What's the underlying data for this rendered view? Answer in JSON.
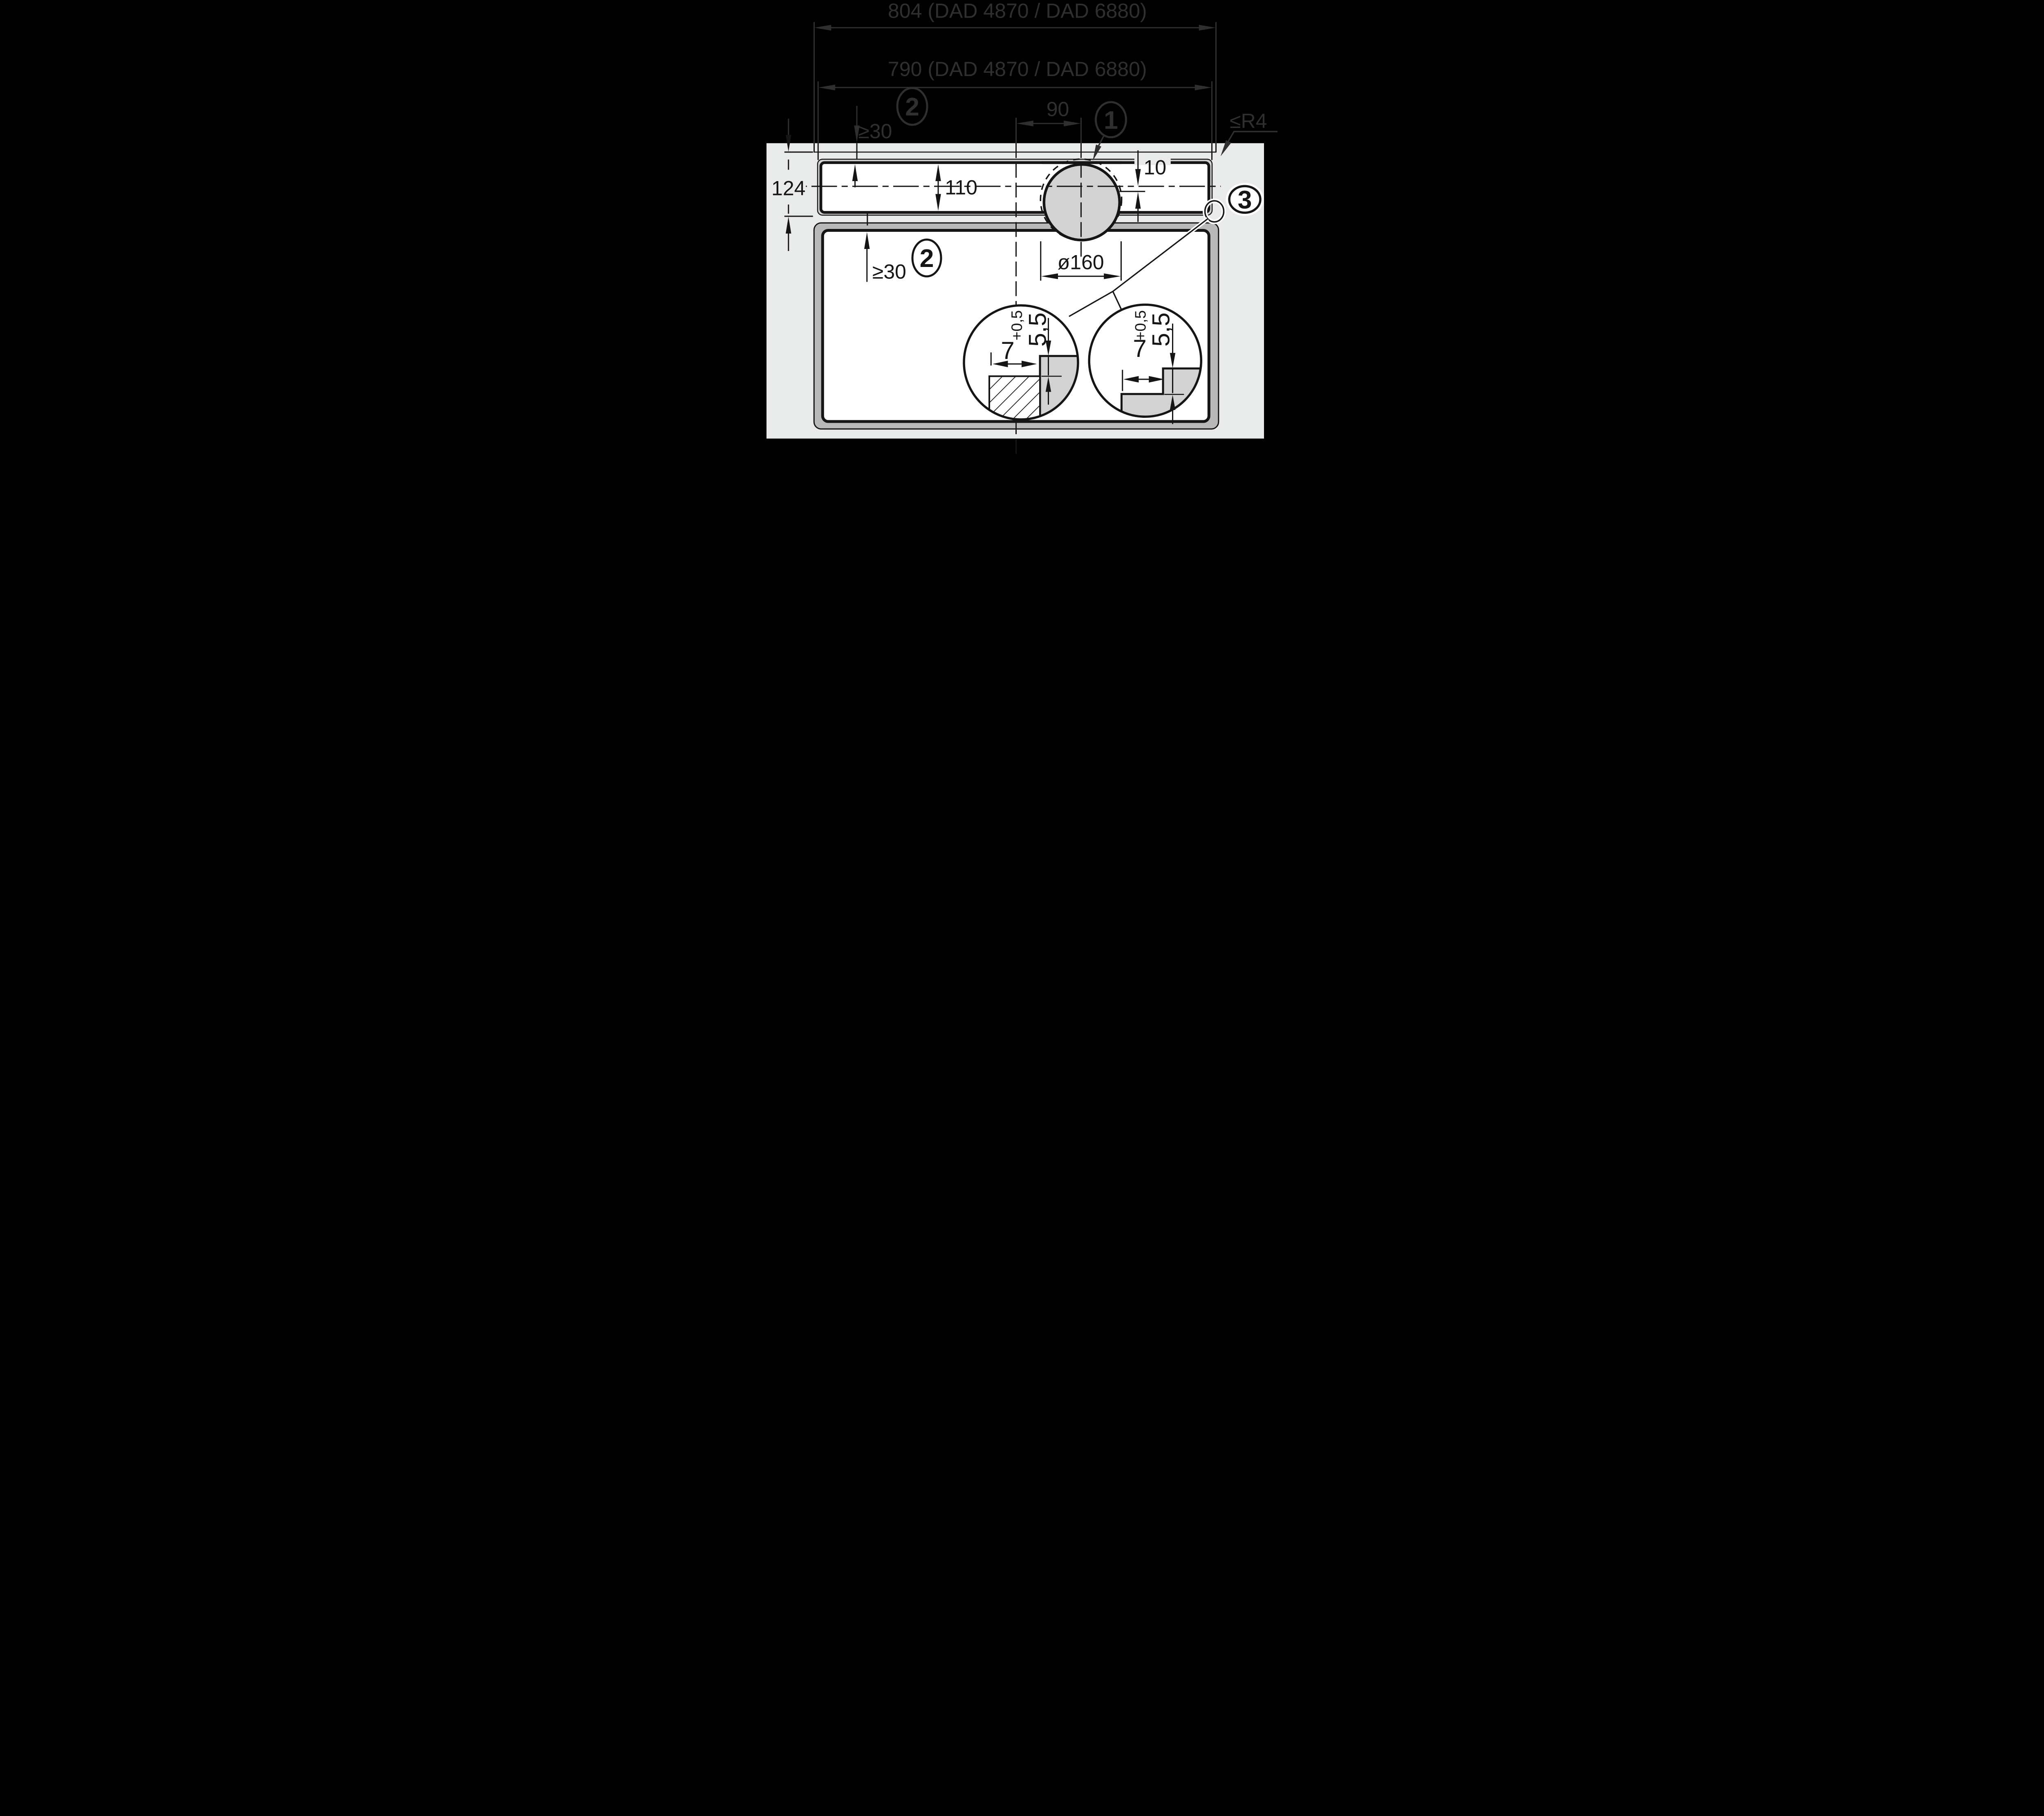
{
  "diagram": {
    "type": "installation-drawing",
    "dimensions": {
      "appliance_width": "804 (DAD 4870 / DAD 6880)",
      "cutout_width": "790 (DAD 4870 / DAD 6880)",
      "rear_clearance": "≥30",
      "duct_center_offset": "90",
      "corner_radius": "≤R4",
      "glass_depth": "124",
      "cutout_depth": "110",
      "front_offset": "10",
      "bottom_clearance": "≥30",
      "duct_diameter": "ø160"
    },
    "callouts": {
      "duct": "1",
      "clearance_note_top": "2",
      "clearance_note_bottom": "2",
      "corner_detail": "3"
    },
    "detail_left": {
      "rebate_width": "7",
      "rebate_depth": "5,5",
      "tolerance": "+0,5"
    },
    "detail_right": {
      "rebate_width": "7",
      "rebate_depth": "5,5",
      "tolerance": "+0,5"
    },
    "colors": {
      "background": "#000000",
      "worktop": "#e9eaea",
      "cutout_band": "#d0d2d2",
      "cabinet_band": "#b9b9b9",
      "duct_fill": "#d2d2d2",
      "ink_light_zone": "#151515",
      "ink_dark_zone": "#2f2f2f",
      "white": "#ffffff"
    }
  }
}
